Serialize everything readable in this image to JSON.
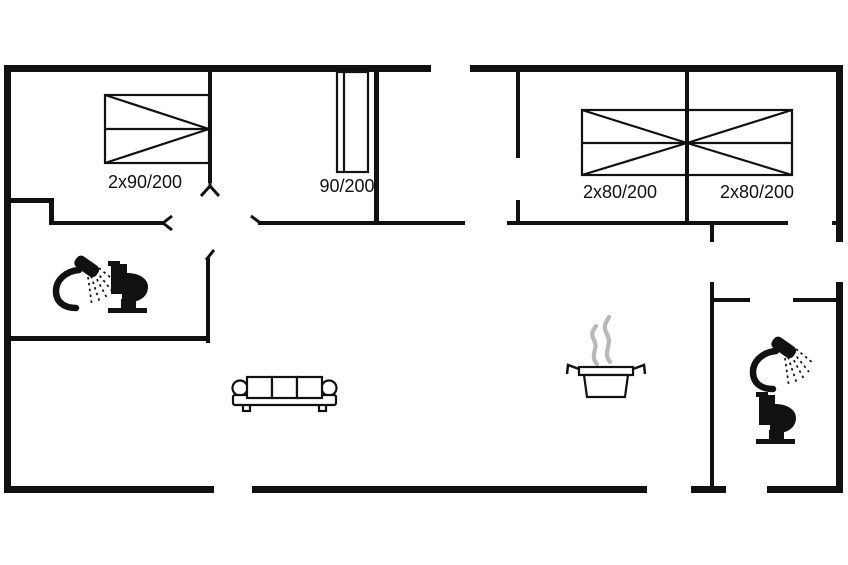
{
  "plan": {
    "title": "holiday-home-floor-plan",
    "background": "#ffffff",
    "wall_color": "#111111",
    "steam_color": "#b8b8b8",
    "text_color": "#111111",
    "beds": {
      "bedroom1_double": "2x90/200",
      "bedroom1_single": "90/200",
      "bedroom2_double": "2x80/200",
      "bedroom3_double": "2x80/200"
    },
    "icons": {
      "bathroom_left_shower": "shower-icon",
      "bathroom_left_toilet": "toilet-icon",
      "living_room_sofa": "sofa-icon",
      "kitchen_pot": "cooking-pot-icon",
      "bathroom_right_shower": "shower-icon",
      "bathroom_right_toilet": "toilet-icon"
    }
  }
}
